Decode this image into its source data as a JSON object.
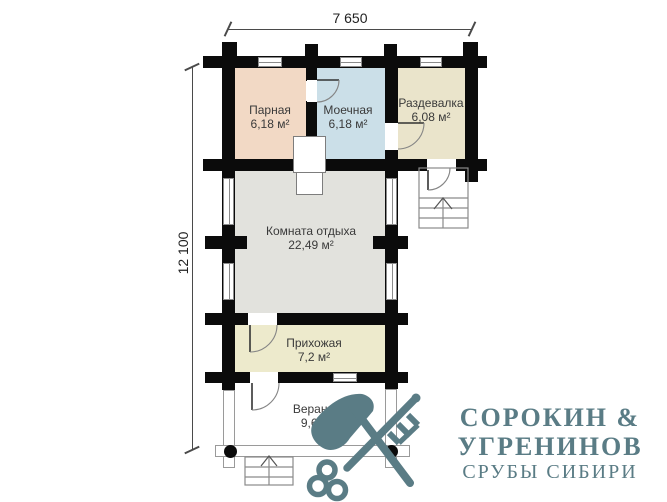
{
  "dimensions": {
    "width": "7 650",
    "height": "12 100"
  },
  "rooms": [
    {
      "id": "parnaya",
      "name": "Парная",
      "area": "6,18 м²"
    },
    {
      "id": "moechnaya",
      "name": "Моечная",
      "area": "6,18 м²"
    },
    {
      "id": "razdevalka",
      "name": "Раздевалка",
      "area": "6,08 м²"
    },
    {
      "id": "komnata",
      "name": "Комната отдыха",
      "area": "22,49 м²"
    },
    {
      "id": "prihozhaya",
      "name": "Прихожая",
      "area": "7,2 м²"
    },
    {
      "id": "veranda",
      "name": "Веранда",
      "area": "9,6 м²"
    }
  ],
  "logo": {
    "line1": "СОРОКИН &",
    "line2": "УГРЕНИНОВ",
    "line3": "СРУБЫ СИБИРИ",
    "color": "#5a7c85"
  },
  "colors": {
    "parnaya": "#f2d9c5",
    "moechnaya": "#cbdfe8",
    "razdevalka": "#eae4cb",
    "komnata": "#e2e2dd",
    "prihozhaya": "#edeacc",
    "veranda": "#ffffff",
    "wall": "#0b0b0b"
  }
}
